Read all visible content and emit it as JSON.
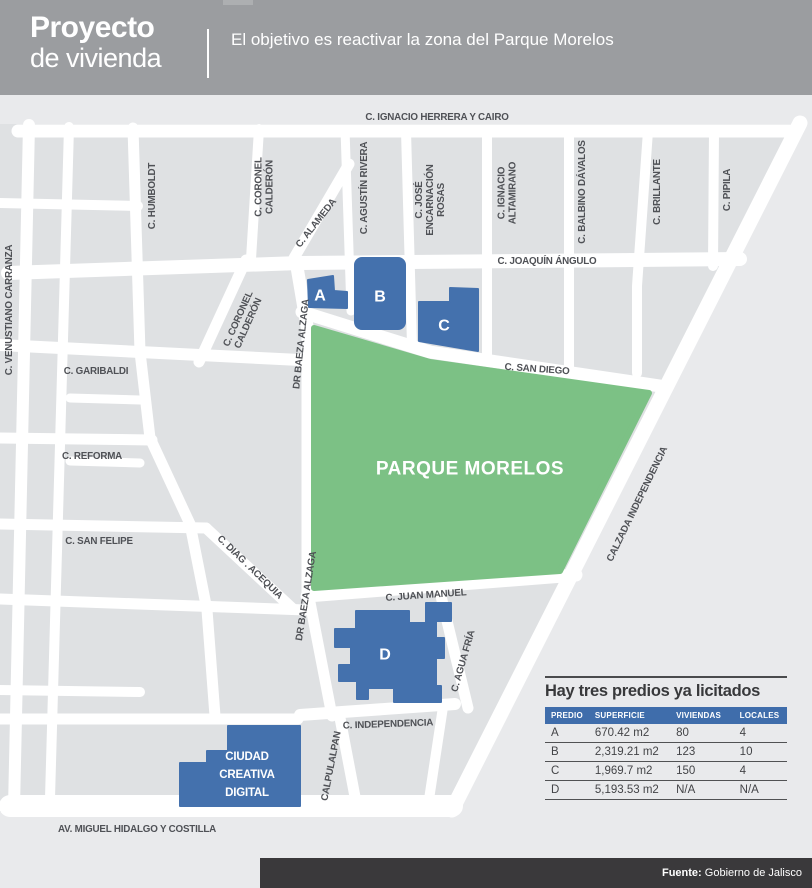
{
  "header": {
    "title_line1": "Proyecto",
    "title_line2": "de vivienda",
    "subtitle": "El objetivo es reactivar la zona del Parque Morelos"
  },
  "map": {
    "park_label": "PARQUE MORELOS",
    "building_labels": [
      {
        "t": "A",
        "x": 320,
        "y": 296
      },
      {
        "t": "B",
        "x": 380,
        "y": 297
      },
      {
        "t": "C",
        "x": 444,
        "y": 326
      },
      {
        "t": "D",
        "x": 385,
        "y": 655
      }
    ],
    "ccd_lines": [
      "CIUDAD",
      "CREATIVA",
      "DIGITAL"
    ],
    "street_labels": [
      {
        "t": "C. IGNACIO HERRERA Y CAIRO",
        "x": 437,
        "y": 117,
        "r": 0
      },
      {
        "t": "C. JOAQUÍN ÁNGULO",
        "x": 547,
        "y": 261,
        "r": 0
      },
      {
        "t": "C. GARIBALDI",
        "x": 96,
        "y": 371,
        "r": 0
      },
      {
        "t": "C. SAN DIEGO",
        "x": 537,
        "y": 369,
        "r": 4
      },
      {
        "t": "C. REFORMA",
        "x": 92,
        "y": 456,
        "r": 0
      },
      {
        "t": "C. SAN FELIPE",
        "x": 99,
        "y": 541,
        "r": 0
      },
      {
        "t": "C. JUAN MANUEL",
        "x": 426,
        "y": 595,
        "r": -4
      },
      {
        "t": "C. INDEPENDENCIA",
        "x": 388,
        "y": 724,
        "r": -2
      },
      {
        "t": "AV. MIGUEL HIDALGO Y COSTILLA",
        "x": 137,
        "y": 829,
        "r": 0
      },
      {
        "t": "C. VENUSTIANO CARRANZA",
        "x": 9,
        "y": 310,
        "r": -90
      },
      {
        "t": "C. HUMBOLDT",
        "x": 152,
        "y": 196,
        "r": -90
      },
      {
        "lines": [
          "C. CORONEL",
          "CALDERÓN"
        ],
        "x": 264,
        "y": 187,
        "r": -90
      },
      {
        "t": "C. AGUSTÍN RIVERA",
        "x": 364,
        "y": 188,
        "r": -90
      },
      {
        "lines": [
          "C. JOSÉ",
          "ENCARNACIÓN",
          "ROSAS"
        ],
        "x": 430,
        "y": 200,
        "r": -90
      },
      {
        "lines": [
          "C. IGNACIO",
          "ALTAMIRANO"
        ],
        "x": 507,
        "y": 193,
        "r": -90
      },
      {
        "t": "C. BALBINO DÁVALOS",
        "x": 582,
        "y": 192,
        "r": -90
      },
      {
        "t": "C. BRILLANTE",
        "x": 657,
        "y": 192,
        "r": -90
      },
      {
        "t": "C. PIPILA",
        "x": 727,
        "y": 190,
        "r": -90
      },
      {
        "t": "C. ALAMEDA",
        "x": 316,
        "y": 223,
        "r": -52
      },
      {
        "lines": [
          "C. CORONEL",
          "CALDERÓN"
        ],
        "x": 243,
        "y": 321,
        "r": -66
      },
      {
        "t": "DR BAEZA ALZAGA",
        "x": 301,
        "y": 344,
        "r": -84
      },
      {
        "t": "DR BAEZA ALZAGA",
        "x": 306,
        "y": 596,
        "r": -81
      },
      {
        "t": "C. DIAG . ACEQUIA",
        "x": 250,
        "y": 567,
        "r": 44
      },
      {
        "t": "CALZADA INDEPENDENCIA",
        "x": 637,
        "y": 504,
        "r": -64
      },
      {
        "t": "C. AGUA FRÍA",
        "x": 463,
        "y": 661,
        "r": -74
      },
      {
        "t": "CALPULALPAN",
        "x": 331,
        "y": 766,
        "r": -79
      }
    ],
    "colors": {
      "block": "#dfe1e3",
      "street": "#ffffff",
      "park": "#7cc185",
      "building": "#4471ad",
      "street_text": "#4f5156"
    }
  },
  "table": {
    "title": "Hay tres predios ya licitados",
    "columns": [
      "PREDIO",
      "SUPERFICIE",
      "VIVIENDAS",
      "LOCALES"
    ],
    "rows": [
      [
        "A",
        "670.42 m2",
        "80",
        "4"
      ],
      [
        "B",
        "2,319.21 m2",
        "123",
        "10"
      ],
      [
        "C",
        "1,969.7 m2",
        "150",
        "4"
      ],
      [
        "D",
        "5,193.53 m2",
        "N/A",
        "N/A"
      ]
    ]
  },
  "footer": {
    "source_label": "Fuente:",
    "source_value": " Gobierno de Jalisco"
  }
}
